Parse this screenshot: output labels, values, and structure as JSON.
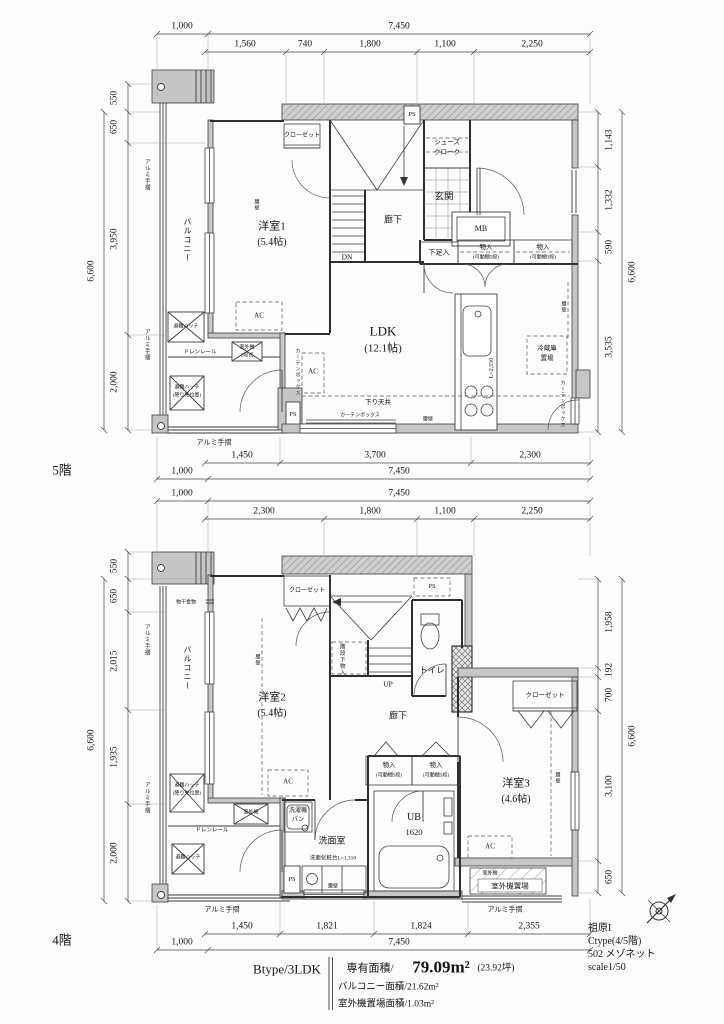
{
  "page": {
    "floor5": "5階",
    "floor4": "4階"
  },
  "common": {
    "balcony": "バルコニー",
    "rail": "アルミ手摺",
    "hatch": "避難ハッチ",
    "hatch_landing": "(降り先位置)",
    "drain_rail": "ドレンレール",
    "outdoor_unit": "室外機",
    "koshikabe": "腰壁",
    "closet": "クローゼット",
    "curtain_box": "カーテンボックス",
    "storage": "物入",
    "shelf5": "(可動棚5段)",
    "shelf3": "(可動棚3段)",
    "ps": "PS",
    "ac": "AC",
    "hall": "廊下",
    "size54": "(5.4帖)"
  },
  "floor5": {
    "room1": "洋室1",
    "ldk": "LDK",
    "ldk_size": "(12.1帖)",
    "genkan": "玄関",
    "shoes_line1": "シューズ",
    "shoes_line2": "クローク",
    "mb": "MB",
    "shoebox": "下足入",
    "dn": "DN",
    "fridge_line1": "冷蔵庫",
    "fridge_line2": "置場",
    "kitchen_len": "L=2,550",
    "lowered_ceiling": "下り天井",
    "outdoor_tier": "2段式",
    "dims": {
      "top_main": [
        "1,000",
        "7,450"
      ],
      "top_sub": [
        "1,560",
        "740",
        "1,800",
        "1,100",
        "2,250"
      ],
      "bottom_sub": [
        "1,450",
        "3,700",
        "2,300"
      ],
      "bottom_main": [
        "1,000",
        "7,450"
      ],
      "left_offset": "550",
      "left": [
        "650",
        "3,950",
        "2,000"
      ],
      "left_total": "6,600",
      "right": [
        "1,143",
        "1,332",
        "590",
        "3,535"
      ],
      "right_total": "6,600"
    }
  },
  "floor4": {
    "room2": "洋室2",
    "room3": "洋室3",
    "room3_size": "(4.6帖)",
    "toilet": "トイレ",
    "up": "UP",
    "stair_storage": "階段下物入",
    "washroom": "洗面室",
    "washer_line1": "洗濯機",
    "washer_line2": "パン",
    "vanity": "洗面化粧台L=1,310",
    "ub": "UB",
    "ub_size": "1620",
    "outdoor_place": "室外機置場",
    "monohoshi": "物干金物",
    "dims": {
      "top_main": [
        "1,000",
        "7,450"
      ],
      "top_sub": [
        "2,300",
        "1,800",
        "1,100",
        "2,250"
      ],
      "bottom_sub": [
        "1,450",
        "1,821",
        "1,824",
        "2,355"
      ],
      "bottom_main": [
        "1,000",
        "7,450"
      ],
      "left_offset": "550",
      "left": [
        "650",
        "2,015",
        "1,935",
        "2,000"
      ],
      "left_total": "6,600",
      "right": [
        "1,958",
        "192",
        "700",
        "3,100",
        "650"
      ],
      "right_total": "6,600"
    }
  },
  "info": {
    "type": "Btype/3LDK",
    "area_label": "専有面積/",
    "area_value": "79.09m²",
    "area_tsubo": "(23.92坪)",
    "balcony_area": "バルコニー面積/21.62m²",
    "outdoor_area": "室外機置場面積/1.03m²"
  },
  "project": {
    "name": "祖原I",
    "type": "Ctype(4/5階)",
    "unit": "502 メゾネット",
    "scale": "scale1/50"
  }
}
